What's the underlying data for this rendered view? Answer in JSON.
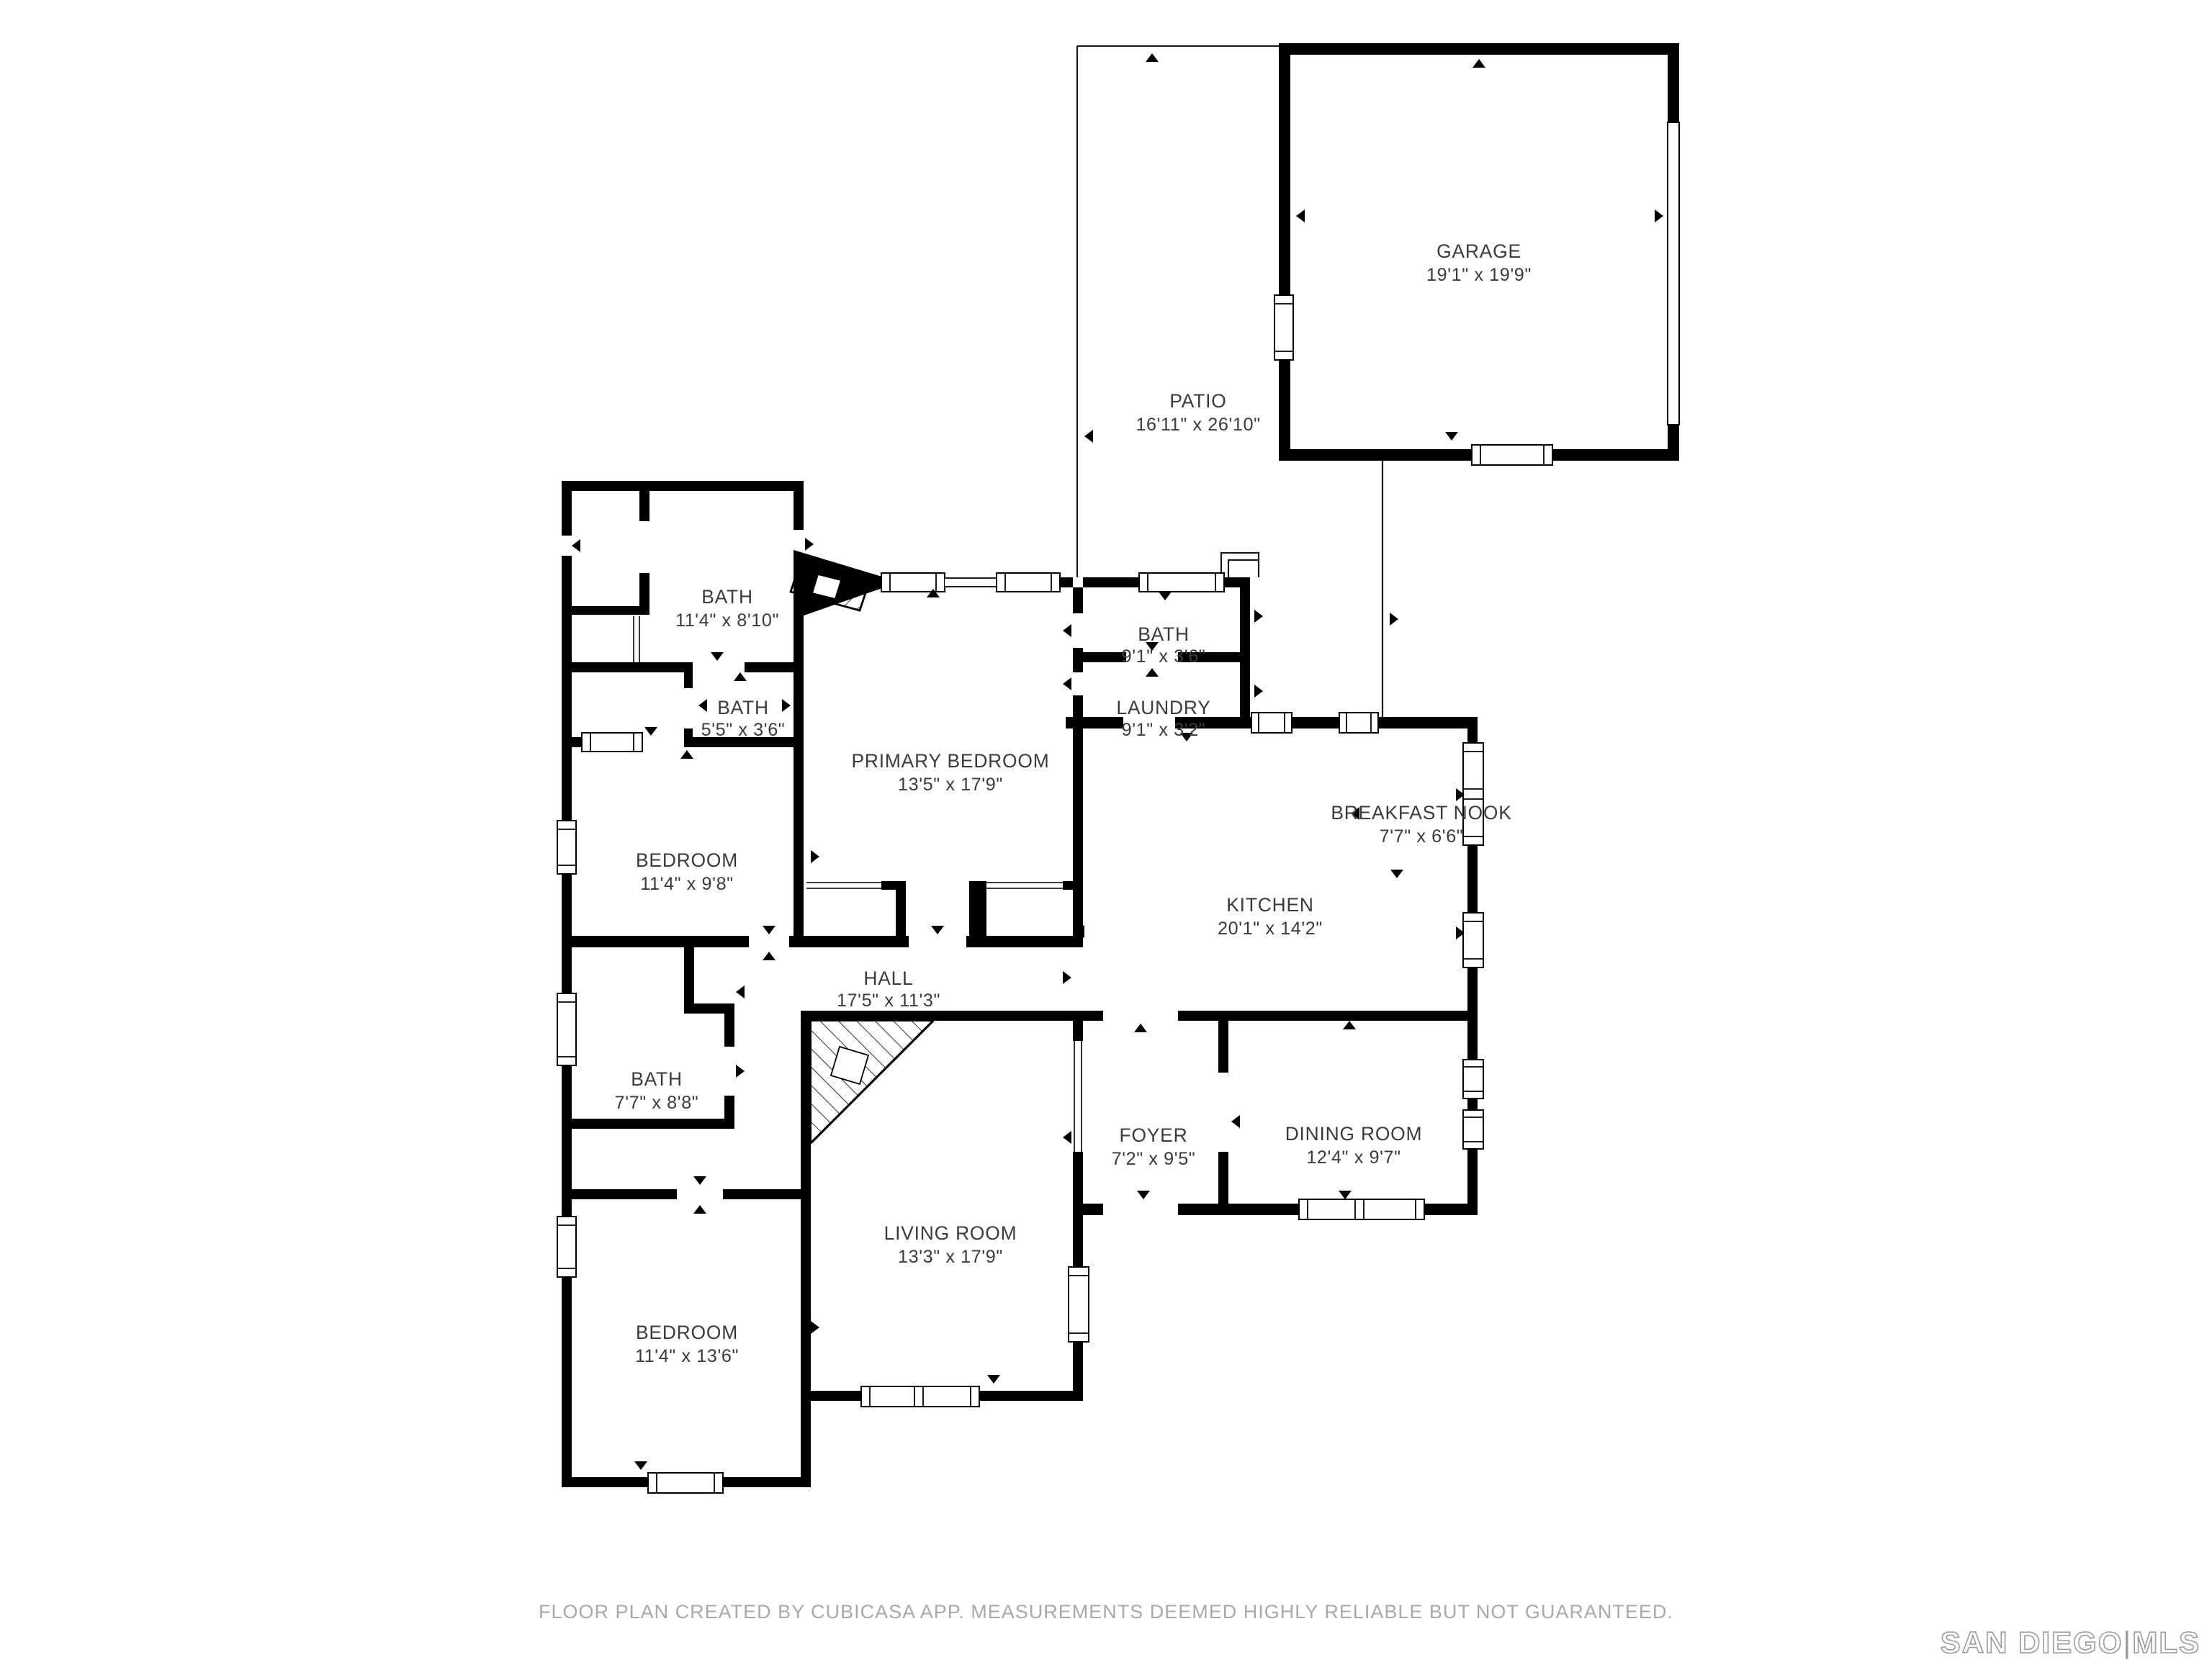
{
  "rooms": {
    "garage": {
      "name": "GARAGE",
      "dims": "19'1\" x 19'9\""
    },
    "patio": {
      "name": "PATIO",
      "dims": "16'11\" x 26'10\""
    },
    "bath_primary": {
      "name": "BATH",
      "dims": "11'4\" x 8'10\""
    },
    "bath_small": {
      "name": "BATH",
      "dims": "5'5\" x 3'6\""
    },
    "bath_right": {
      "name": "BATH",
      "dims": "9'1\" x 3'6\""
    },
    "laundry": {
      "name": "LAUNDRY",
      "dims": "9'1\" x 3'2\""
    },
    "primary_bedroom": {
      "name": "PRIMARY BEDROOM",
      "dims": "13'5\" x 17'9\""
    },
    "breakfast_nook": {
      "name": "BREAKFAST NOOK",
      "dims": "7'7\" x 6'6\""
    },
    "bedroom_mid": {
      "name": "BEDROOM",
      "dims": "11'4\" x 9'8\""
    },
    "kitchen": {
      "name": "KITCHEN",
      "dims": "20'1\" x 14'2\""
    },
    "hall": {
      "name": "HALL",
      "dims": "17'5\" x 11'3\""
    },
    "bath_lower": {
      "name": "BATH",
      "dims": "7'7\" x 8'8\""
    },
    "foyer": {
      "name": "FOYER",
      "dims": "7'2\" x 9'5\""
    },
    "dining": {
      "name": "DINING ROOM",
      "dims": "12'4\" x 9'7\""
    },
    "living": {
      "name": "LIVING ROOM",
      "dims": "13'3\" x 17'9\""
    },
    "bedroom_bottom": {
      "name": "BEDROOM",
      "dims": "11'4\" x 13'6\""
    }
  },
  "footer": {
    "disclaimer": "FLOOR PLAN CREATED BY CUBICASA APP. MEASUREMENTS DEEMED HIGHLY RELIABLE BUT NOT GUARANTEED."
  },
  "branding": {
    "mls_left": "SAN DIEGO",
    "separator": "|",
    "mls_right": "MLS"
  },
  "colors": {
    "wall": "#000000",
    "label": "#3b3b3b",
    "footer_text": "#a9a9a9",
    "logo_outline": "#9b9b9b",
    "background": "#ffffff"
  }
}
